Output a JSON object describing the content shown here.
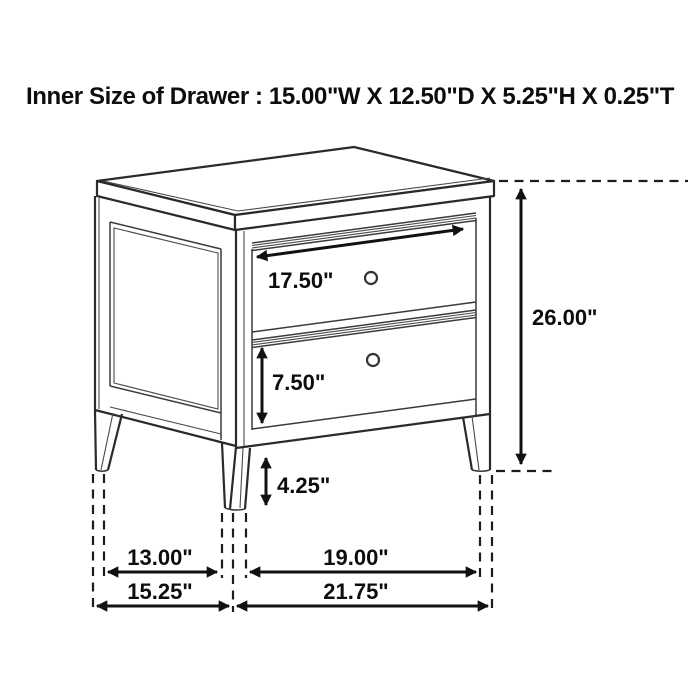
{
  "title": "Inner Size of Drawer : 15.00\"W X 12.50\"D X 5.25\"H X 0.25\"T",
  "figure": {
    "kind": "furniture-dimension-diagram",
    "item": "two-drawer nightstand",
    "inner_drawer_size": {
      "width": "15.00\"W",
      "depth": "12.50\"D",
      "height": "5.25\"H",
      "thickness": "0.25\"T"
    },
    "dimensions": {
      "top_drawer_width": "17.50\"",
      "bottom_drawer_height": "7.50\"",
      "leg_clearance_height": "4.25\"",
      "overall_height": "26.00\"",
      "side_leg_spacing": "13.00\"",
      "front_leg_spacing": "19.00\"",
      "overall_depth": "15.25\"",
      "overall_width": "21.75\""
    },
    "line_color": "#2a2a2a",
    "background_color": "#ffffff"
  }
}
